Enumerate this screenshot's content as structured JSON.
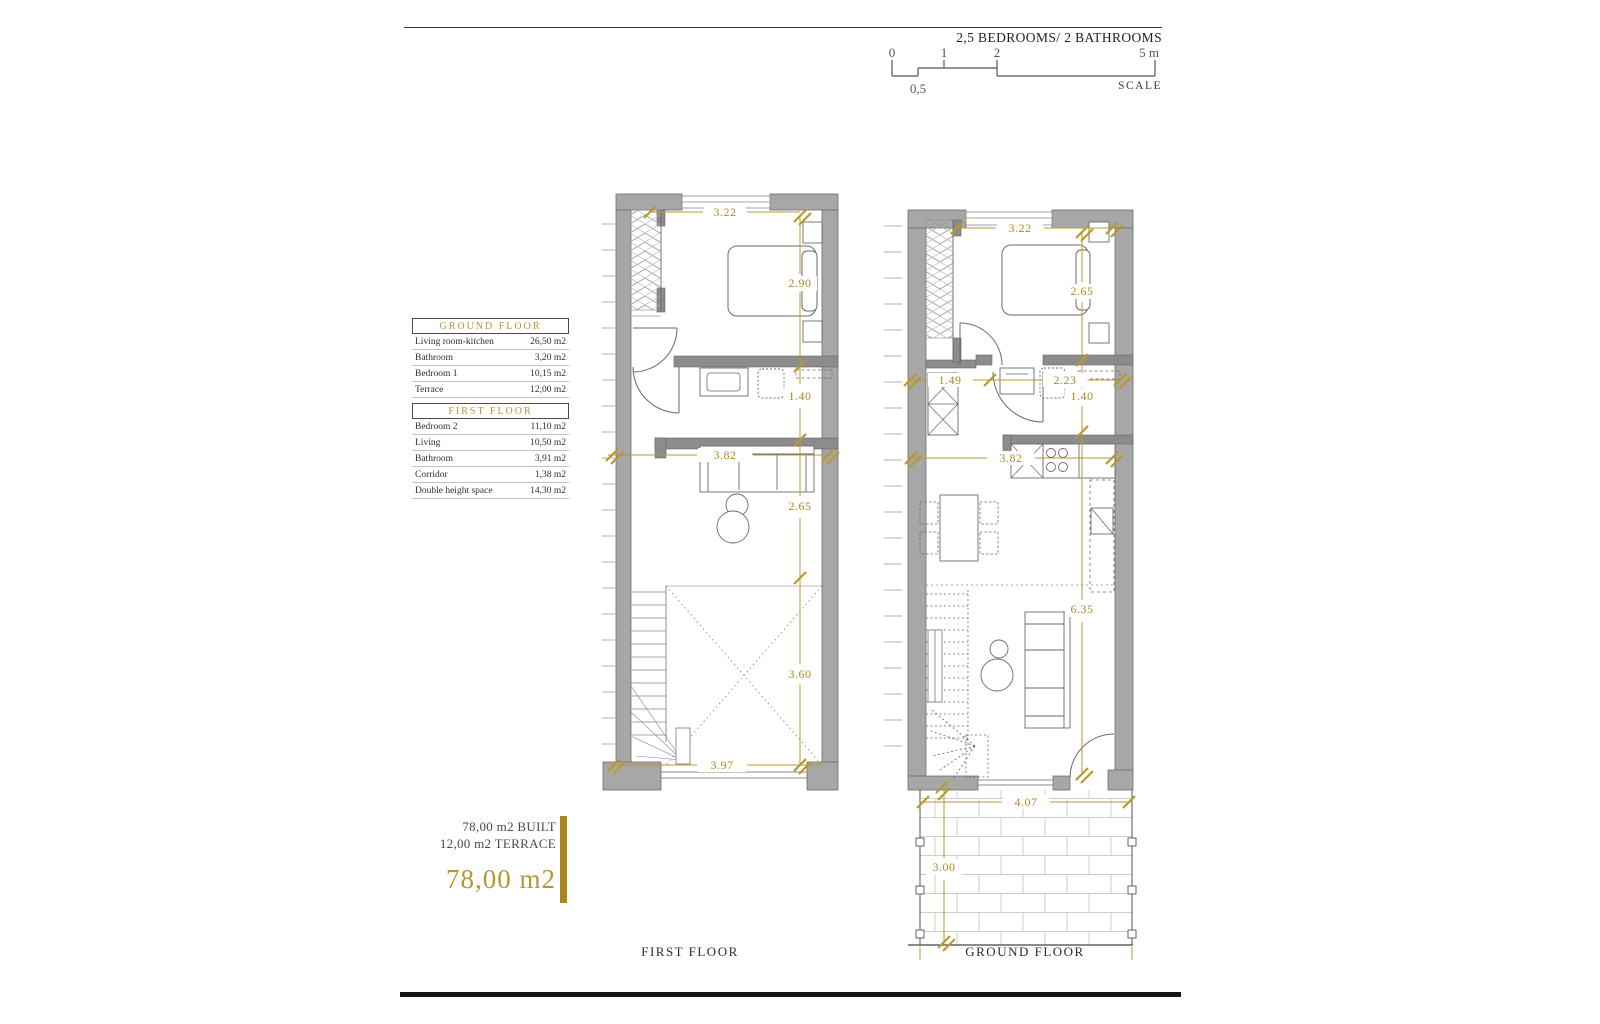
{
  "header": {
    "title": "2,5 BEDROOMS/ 2 BATHROOMS",
    "scale": {
      "t0": "0",
      "t05": "0,5",
      "t1": "1",
      "t2": "2",
      "t5": "5 m",
      "caption": "SCALE"
    }
  },
  "legend": {
    "ground": {
      "title": "GROUND FLOOR",
      "rows": [
        {
          "label": "Living room-kitchen",
          "value": "26,50 m2"
        },
        {
          "label": "Bathroom",
          "value": "3,20 m2"
        },
        {
          "label": "Bedroom 1",
          "value": "10,15 m2"
        },
        {
          "label": "Terrace",
          "value": "12,00 m2"
        }
      ]
    },
    "first": {
      "title": "FIRST FLOOR",
      "rows": [
        {
          "label": "Bedroom 2",
          "value": "11,10 m2"
        },
        {
          "label": "Living",
          "value": "10,50 m2"
        },
        {
          "label": "Bathroom",
          "value": "3,91 m2"
        },
        {
          "label": "Corridor",
          "value": "1,38 m2"
        },
        {
          "label": "Double height space",
          "value": "14,30 m2"
        }
      ]
    }
  },
  "summary": {
    "built": "78,00 m2 BUILT",
    "terrace": "12,00 m2 TERRACE",
    "total": "78,00 m2"
  },
  "plans": {
    "first": {
      "caption": "FIRST FLOOR",
      "dims": {
        "w_top": "3.22",
        "h_bed": "2.90",
        "h_bath": "1.40",
        "w_living": "3.82",
        "h_living": "2.65",
        "h_void": "3.60",
        "w_bottom": "3.97"
      }
    },
    "ground": {
      "caption": "GROUND FLOOR",
      "dims": {
        "w_top": "3.22",
        "h_bed": "2.65",
        "w_entry": "1.49",
        "w_bath": "2.23",
        "h_bath": "1.40",
        "w_kitchen": "3.82",
        "h_living": "6.35",
        "w_terrace": "4.07",
        "h_terrace": "3.00"
      }
    }
  },
  "colors": {
    "gold": "#b9992e",
    "wall": "#a7a7a7",
    "ink": "#2f2f2f"
  }
}
